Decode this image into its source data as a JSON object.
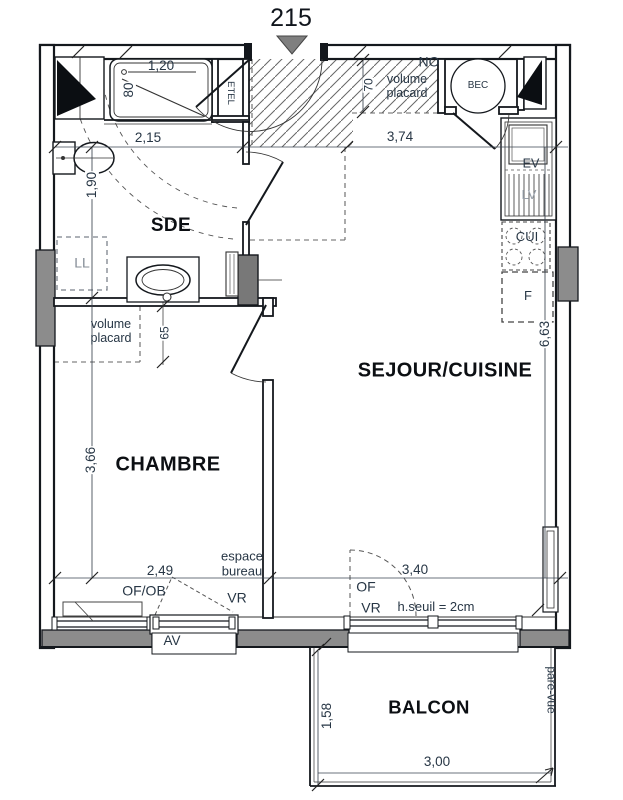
{
  "unit": {
    "number": "215"
  },
  "rooms": {
    "sde": "SDE",
    "sejour_cuisine": "SEJOUR/CUISINE",
    "chambre": "CHAMBRE",
    "balcon": "BALCON"
  },
  "fixtures": {
    "etel": "ETEL",
    "bec": "BEC",
    "lave_linge": "LL",
    "evier": "EV",
    "lave_vaisselle": "LV",
    "cuisiniere": "CUI",
    "frigo": "F"
  },
  "annotations": {
    "orientation": "NO",
    "volume_placard_entree": {
      "line1": "volume",
      "line2": "placard"
    },
    "volume_placard_sde": {
      "line1": "volume",
      "line2": "placard"
    },
    "espace_bureau": {
      "line1": "espace",
      "line2": "bureau"
    },
    "of_ob": "OF/OB",
    "vr_chambre": "VR",
    "of": "OF",
    "vr_sejour": "VR",
    "h_seuil": "h.seuil = 2cm",
    "av": "AV",
    "pare_vue": "pare-vue"
  },
  "dimensions": {
    "douche_largeur": "1,20",
    "douche_profondeur": "80",
    "sde_largeur": "2,15",
    "sejour_largeur": "3,74",
    "placard_profondeur": "70",
    "sde_longueur": "1,90",
    "placard_sde": "65",
    "sejour_longueur": "6,63",
    "chambre_longueur": "3,66",
    "chambre_largeur": "2,49",
    "baie_largeur": "3,40",
    "balcon_profondeur": "1,58",
    "balcon_largeur": "3,00"
  },
  "colors": {
    "line": "#14181d",
    "poche_gray": "#8c8c8c",
    "annotation_text": "#273645",
    "room_text": "#0c0f13",
    "marker_gray": "#7f7f7f"
  }
}
